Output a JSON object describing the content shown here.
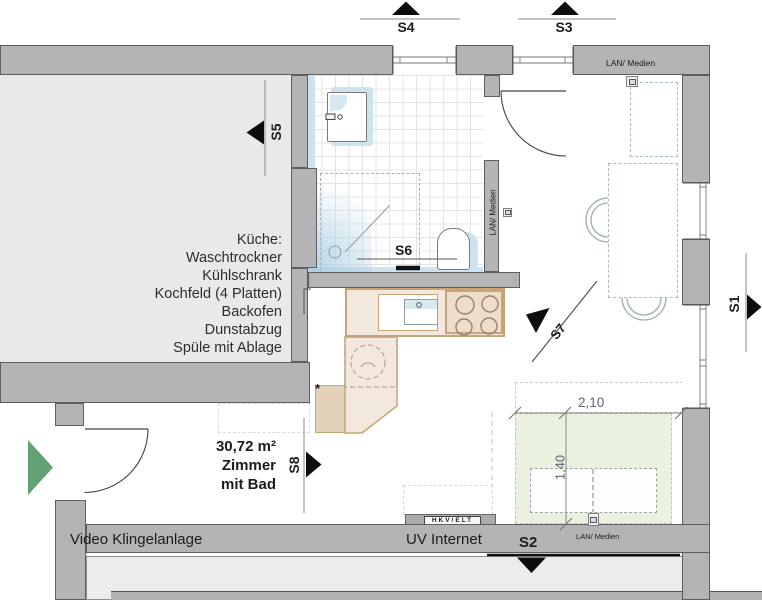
{
  "plan": {
    "markers": {
      "s1": "S1",
      "s2": "S2",
      "s3": "S3",
      "s4": "S4",
      "s5": "S5",
      "s6": "S6",
      "s7": "S7",
      "s8": "S8"
    },
    "kitchen_legend": {
      "title": "Küche:",
      "items": [
        "Waschtrockner",
        "Kühlschrank",
        "Kochfeld (4 Platten)",
        "Backofen",
        "Dunstabzug",
        "Spüle mit Ablage"
      ]
    },
    "room": {
      "area": "30,72 m²",
      "name_line1": "Zimmer",
      "name_line2": "mit Bad"
    },
    "labels": {
      "video_intercom": "Video Klingelanlage",
      "uv_internet": "UV Internet",
      "hkv_elt": "HKV/ELT",
      "lan_top": "LAN/ Medien",
      "lan_bath": "LAN/ Medien",
      "lan_bed": "LAN/ Medien",
      "asterisk": "*"
    },
    "dimensions": {
      "bed_width": "2,10",
      "bed_depth": "1,40"
    },
    "colors": {
      "wall": "#b4b4b4",
      "neighbor_room": "#e9e9e9",
      "lower_room": "#ececec",
      "counter": "#f2e8de",
      "counter_dark": "#e3d1ba",
      "cooktop": "#eeddc8",
      "water_blue": "#cfe3ee",
      "bed_area_green": "#eaf1e0",
      "entrance_arrow": "#61a173",
      "section_black": "#0d0d0d"
    }
  }
}
